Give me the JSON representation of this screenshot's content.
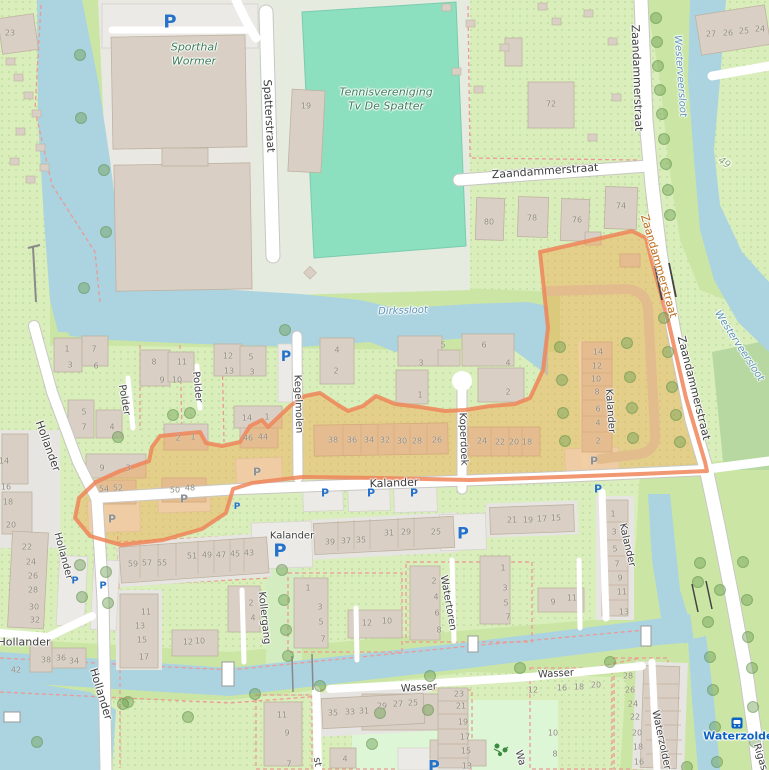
{
  "map": {
    "colors": {
      "water": "#abd3e0",
      "land_base": "#d9eebb",
      "grass": "#cbe6a4",
      "pitch": "#8ce0bf",
      "building": "#d9cfc4",
      "highlight_fill": "#f6a042",
      "highlight_stroke": "#ef8559",
      "path_dashed": "#ec9a94",
      "parking_blue": "#2672c8",
      "transit_blue": "#0d62c4"
    },
    "street_labels": [
      [
        "Spatterstraat",
        269,
        116,
        87,
        11
      ],
      [
        "Zaandammerstraat",
        545,
        171,
        -4,
        11
      ],
      [
        "Zaandammerstraat",
        637,
        78,
        88,
        11
      ],
      [
        "Zaandammerstraat",
        659,
        266,
        74,
        11,
        "#c06a18"
      ],
      [
        "Zaandammerstraat",
        694,
        388,
        76,
        11
      ],
      [
        "Hollander",
        48,
        446,
        70,
        11
      ],
      [
        "Hollander",
        63,
        556,
        75,
        10
      ],
      [
        "Hollander",
        24,
        642,
        0,
        11
      ],
      [
        "Hollander",
        101,
        694,
        73,
        11
      ],
      [
        "Polder",
        124,
        400,
        80,
        10
      ],
      [
        "Polder",
        197,
        387,
        84,
        10
      ],
      [
        "Kegelmolen",
        298,
        404,
        88,
        10
      ],
      [
        "Koperdoek",
        463,
        439,
        88,
        10
      ],
      [
        "Kalander",
        394,
        483,
        -2,
        11
      ],
      [
        "Kalander",
        292,
        536,
        0,
        10
      ],
      [
        "Kalander",
        610,
        411,
        86,
        10
      ],
      [
        "Kalander",
        627,
        545,
        77,
        10
      ],
      [
        "Kollergang",
        264,
        618,
        84,
        10
      ],
      [
        "Watertoren",
        448,
        603,
        80,
        10
      ],
      [
        "Wasser",
        419,
        688,
        -4,
        10
      ],
      [
        "Wasser",
        556,
        674,
        -3,
        10
      ],
      [
        "Waterzolder",
        661,
        740,
        78,
        10
      ],
      [
        "Rigas",
        760,
        757,
        73,
        10
      ],
      [
        "st",
        317,
        762,
        80,
        10
      ],
      [
        "Wa",
        520,
        758,
        74,
        10
      ]
    ],
    "water_labels": [
      [
        "Westerveersloot",
        680,
        76,
        86
      ],
      [
        "Westerveersloot",
        739,
        346,
        57
      ],
      [
        "Dirkssloot",
        403,
        311,
        -2
      ]
    ],
    "poi_labels": [
      [
        "Sporthal\nWormer",
        194,
        55
      ],
      [
        "Tennisvereniging\nTv De Spatter",
        386,
        100
      ]
    ],
    "area_labels": [
      [
        "49",
        724,
        163,
        35
      ]
    ],
    "transit": {
      "label": "Waterzolder",
      "x": 741,
      "y": 736,
      "icon_x": 737,
      "icon_y": 719
    },
    "parking_icons": [
      [
        170,
        22,
        18
      ],
      [
        286,
        357,
        14
      ],
      [
        325,
        493,
        11
      ],
      [
        371,
        493,
        11
      ],
      [
        414,
        493,
        11
      ],
      [
        598,
        489,
        11
      ],
      [
        237,
        507,
        9
      ],
      [
        280,
        551,
        18
      ],
      [
        463,
        533,
        16
      ],
      [
        75,
        581,
        10
      ],
      [
        103,
        586,
        10
      ],
      [
        434,
        766,
        16
      ]
    ],
    "parking_muted": [
      [
        257,
        472,
        11
      ],
      [
        184,
        499,
        11
      ],
      [
        112,
        519,
        11
      ],
      [
        594,
        461,
        11
      ]
    ],
    "house_numbers": [
      [
        "23",
        10,
        33
      ],
      [
        "19",
        306,
        106
      ],
      [
        "72",
        551,
        104
      ],
      [
        "80",
        489,
        222
      ],
      [
        "78",
        532,
        218
      ],
      [
        "76",
        577,
        220
      ],
      [
        "74",
        621,
        206
      ],
      [
        "27",
        711,
        34
      ],
      [
        "26",
        728,
        33
      ],
      [
        "25",
        744,
        31
      ],
      [
        "24",
        760,
        29
      ],
      [
        "1",
        67,
        349
      ],
      [
        "7",
        94,
        349
      ],
      [
        "3",
        70,
        365
      ],
      [
        "6",
        96,
        366
      ],
      [
        "8",
        154,
        362
      ],
      [
        "11",
        182,
        362
      ],
      [
        "9",
        162,
        380
      ],
      [
        "10",
        177,
        380
      ],
      [
        "12",
        228,
        356
      ],
      [
        "5",
        251,
        357
      ],
      [
        "13",
        229,
        371
      ],
      [
        "3",
        252,
        372
      ],
      [
        "4",
        337,
        350
      ],
      [
        "2",
        336,
        371
      ],
      [
        "5",
        84,
        412
      ],
      [
        "7",
        84,
        427
      ],
      [
        "4",
        112,
        427
      ],
      [
        "14",
        247,
        418
      ],
      [
        "1",
        267,
        417
      ],
      [
        "2",
        178,
        438
      ],
      [
        "1",
        193,
        437
      ],
      [
        "46",
        248,
        438
      ],
      [
        "44",
        263,
        437
      ],
      [
        "9",
        102,
        468
      ],
      [
        "3",
        128,
        468
      ],
      [
        "50",
        175,
        490
      ],
      [
        "48",
        190,
        488
      ],
      [
        "54",
        104,
        489
      ],
      [
        "52",
        118,
        488
      ],
      [
        "5",
        443,
        345
      ],
      [
        "6",
        484,
        345
      ],
      [
        "3",
        421,
        363
      ],
      [
        "4",
        508,
        363
      ],
      [
        "1",
        420,
        395
      ],
      [
        "2",
        508,
        392
      ],
      [
        "38",
        333,
        440
      ],
      [
        "36",
        352,
        440
      ],
      [
        "34",
        369,
        440
      ],
      [
        "32",
        385,
        440
      ],
      [
        "30",
        402,
        441
      ],
      [
        "28",
        417,
        441
      ],
      [
        "26",
        437,
        440
      ],
      [
        "24",
        482,
        441
      ],
      [
        "22",
        500,
        442
      ],
      [
        "20",
        514,
        442
      ],
      [
        "18",
        527,
        442
      ],
      [
        "14",
        598,
        352
      ],
      [
        "12",
        597,
        366
      ],
      [
        "10",
        596,
        379
      ],
      [
        "8",
        597,
        392
      ],
      [
        "6",
        598,
        409
      ],
      [
        "4",
        598,
        423
      ],
      [
        "2",
        598,
        441
      ],
      [
        "14",
        4,
        461
      ],
      [
        "16",
        6,
        487
      ],
      [
        "18",
        8,
        502
      ],
      [
        "20",
        11,
        525
      ],
      [
        "22",
        27,
        547
      ],
      [
        "24",
        31,
        562
      ],
      [
        "26",
        33,
        576
      ],
      [
        "28",
        33,
        590
      ],
      [
        "30",
        34,
        607
      ],
      [
        "32",
        35,
        620
      ],
      [
        "42",
        16,
        670
      ],
      [
        "38",
        46,
        660
      ],
      [
        "36",
        61,
        658
      ],
      [
        "34",
        74,
        661
      ],
      [
        "59",
        133,
        564
      ],
      [
        "57",
        147,
        563
      ],
      [
        "55",
        162,
        563
      ],
      [
        "51",
        192,
        556
      ],
      [
        "49",
        207,
        555
      ],
      [
        "47",
        221,
        555
      ],
      [
        "45",
        235,
        554
      ],
      [
        "43",
        249,
        553
      ],
      [
        "39",
        330,
        542
      ],
      [
        "37",
        346,
        541
      ],
      [
        "35",
        361,
        540
      ],
      [
        "31",
        389,
        533
      ],
      [
        "29",
        406,
        532
      ],
      [
        "25",
        436,
        532
      ],
      [
        "21",
        512,
        520
      ],
      [
        "19",
        528,
        520
      ],
      [
        "17",
        542,
        519
      ],
      [
        "15",
        556,
        518
      ],
      [
        "1",
        613,
        514
      ],
      [
        "3",
        614,
        532
      ],
      [
        "5",
        615,
        549
      ],
      [
        "7",
        617,
        564
      ],
      [
        "9",
        620,
        578
      ],
      [
        "11",
        622,
        592
      ],
      [
        "13",
        624,
        612
      ],
      [
        "11",
        146,
        612
      ],
      [
        "13",
        140,
        626
      ],
      [
        "15",
        142,
        640
      ],
      [
        "17",
        144,
        657
      ],
      [
        "12",
        188,
        642
      ],
      [
        "10",
        200,
        641
      ],
      [
        "2",
        251,
        603
      ],
      [
        "4",
        253,
        618
      ],
      [
        "1",
        308,
        588
      ],
      [
        "3",
        320,
        607
      ],
      [
        "5",
        321,
        622
      ],
      [
        "7",
        323,
        639
      ],
      [
        "12",
        367,
        623
      ],
      [
        "10",
        387,
        621
      ],
      [
        "2",
        434,
        581
      ],
      [
        "4",
        436,
        597
      ],
      [
        "6",
        437,
        613
      ],
      [
        "8",
        439,
        630
      ],
      [
        "1",
        503,
        568
      ],
      [
        "3",
        505,
        588
      ],
      [
        "5",
        506,
        603
      ],
      [
        "7",
        508,
        617
      ],
      [
        "9",
        553,
        602
      ],
      [
        "11",
        572,
        598
      ],
      [
        "35",
        333,
        713
      ],
      [
        "33",
        350,
        712
      ],
      [
        "31",
        364,
        711
      ],
      [
        "29",
        382,
        706
      ],
      [
        "27",
        398,
        704
      ],
      [
        "25",
        413,
        703
      ],
      [
        "23",
        459,
        694
      ],
      [
        "21",
        461,
        706
      ],
      [
        "19",
        463,
        722
      ],
      [
        "17",
        465,
        737
      ],
      [
        "15",
        466,
        751
      ],
      [
        "13",
        467,
        766
      ],
      [
        "11",
        282,
        715
      ],
      [
        "9",
        287,
        733
      ],
      [
        "7",
        289,
        764
      ],
      [
        "4",
        345,
        759
      ],
      [
        "12",
        533,
        690
      ],
      [
        "16",
        562,
        688
      ],
      [
        "18",
        579,
        687
      ],
      [
        "20",
        596,
        685
      ],
      [
        "10",
        553,
        733
      ],
      [
        "8",
        555,
        754
      ],
      [
        "28",
        628,
        676
      ],
      [
        "26",
        630,
        690
      ],
      [
        "24",
        633,
        704
      ],
      [
        "22",
        635,
        717
      ],
      [
        "20",
        637,
        733
      ],
      [
        "18",
        638,
        747
      ],
      [
        "16",
        639,
        762
      ]
    ],
    "trees": [
      [
        656,
        18
      ],
      [
        657,
        42
      ],
      [
        658,
        66
      ],
      [
        660,
        90
      ],
      [
        662,
        114
      ],
      [
        664,
        139
      ],
      [
        666,
        164
      ],
      [
        668,
        190
      ],
      [
        670,
        215
      ],
      [
        664,
        318
      ],
      [
        668,
        352
      ],
      [
        672,
        387
      ],
      [
        676,
        415
      ],
      [
        680,
        442
      ],
      [
        560,
        347
      ],
      [
        562,
        380
      ],
      [
        563,
        413
      ],
      [
        565,
        441
      ],
      [
        627,
        343
      ],
      [
        630,
        377
      ],
      [
        632,
        408
      ],
      [
        633,
        438
      ],
      [
        80,
        55
      ],
      [
        81,
        118
      ],
      [
        104,
        170
      ],
      [
        106,
        232
      ],
      [
        84,
        288
      ],
      [
        285,
        330
      ],
      [
        173,
        415
      ],
      [
        190,
        413
      ],
      [
        118,
        437
      ],
      [
        282,
        570
      ],
      [
        284,
        600
      ],
      [
        286,
        630
      ],
      [
        288,
        656
      ],
      [
        80,
        565
      ],
      [
        82,
        597
      ],
      [
        106,
        572
      ],
      [
        108,
        603
      ],
      [
        128,
        702
      ],
      [
        188,
        717
      ],
      [
        255,
        694
      ],
      [
        320,
        686
      ],
      [
        430,
        676
      ],
      [
        520,
        668
      ],
      [
        610,
        662
      ],
      [
        37,
        742
      ],
      [
        123,
        704
      ],
      [
        380,
        713
      ],
      [
        428,
        710
      ],
      [
        372,
        744
      ],
      [
        700,
        563
      ],
      [
        743,
        562
      ],
      [
        698,
        582
      ],
      [
        720,
        590
      ],
      [
        747,
        600
      ],
      [
        708,
        622
      ],
      [
        748,
        637
      ],
      [
        710,
        657
      ],
      [
        752,
        668
      ],
      [
        713,
        690
      ],
      [
        753,
        707
      ],
      [
        715,
        727
      ],
      [
        755,
        742
      ],
      [
        717,
        762
      ],
      [
        687,
        767
      ]
    ]
  }
}
